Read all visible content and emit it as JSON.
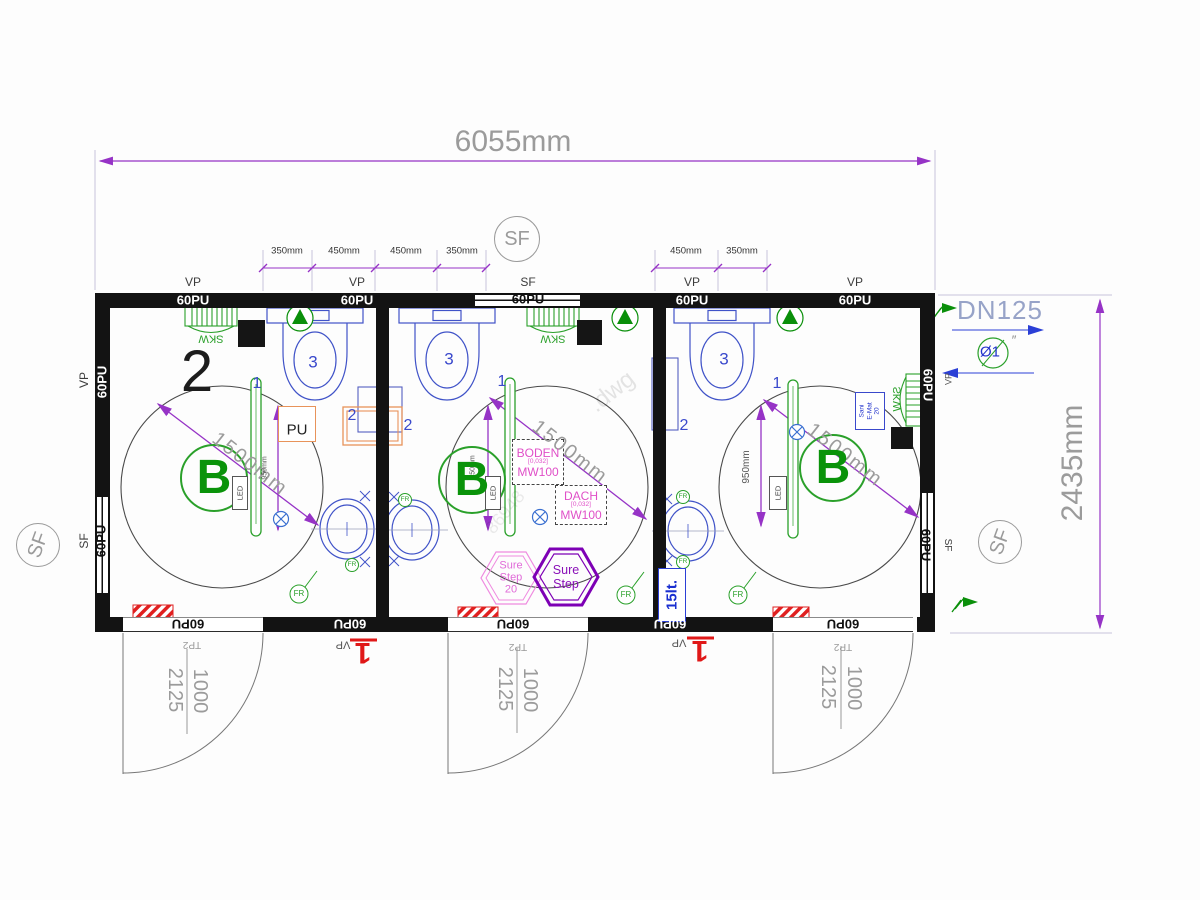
{
  "dims": {
    "overall_width": "6055mm",
    "overall_height": "2435mm",
    "sub_left": [
      "350mm",
      "450mm",
      "450mm",
      "350mm"
    ],
    "sub_right": [
      "450mm",
      "350mm"
    ],
    "turning_circle": "1500mm",
    "grab_height": "950mm",
    "door_width": "1000",
    "door_height": "2125",
    "door_type": "TP2"
  },
  "walls": {
    "panel": "60PU"
  },
  "marks": {
    "vp": "VP",
    "sf": "SF"
  },
  "plumbing": {
    "dn": "DN125",
    "pipe": "Ø1",
    "inch": "″",
    "boiler": "15lt."
  },
  "rooms": {
    "plan_number": "2",
    "barrier_free": "B",
    "pos1": "1",
    "pos2": "2",
    "pos3": "3",
    "heater": "SKW",
    "pu_tag": "PU",
    "led": "LED",
    "fr": "FR",
    "sani": {
      "l1": "Sani",
      "l2": "E-Mat",
      "l3": "20"
    },
    "boden": {
      "title": "BODEN",
      "value": "[0,032]",
      "mat": "MW100"
    },
    "dach": {
      "title": "DACH",
      "value": "[0,032]",
      "mat": "MW100"
    },
    "sure_step": {
      "l1": "Sure",
      "l2": "Step",
      "size": "20"
    },
    "datum": "1"
  },
  "watermark": {
    "w1": ".dwg",
    "w2": "86948"
  },
  "colors": {
    "dim": "#9633c6",
    "fixture": "#4053c8",
    "green": "#2aa02a",
    "red": "#e02020",
    "magenta": "#e050c8"
  }
}
